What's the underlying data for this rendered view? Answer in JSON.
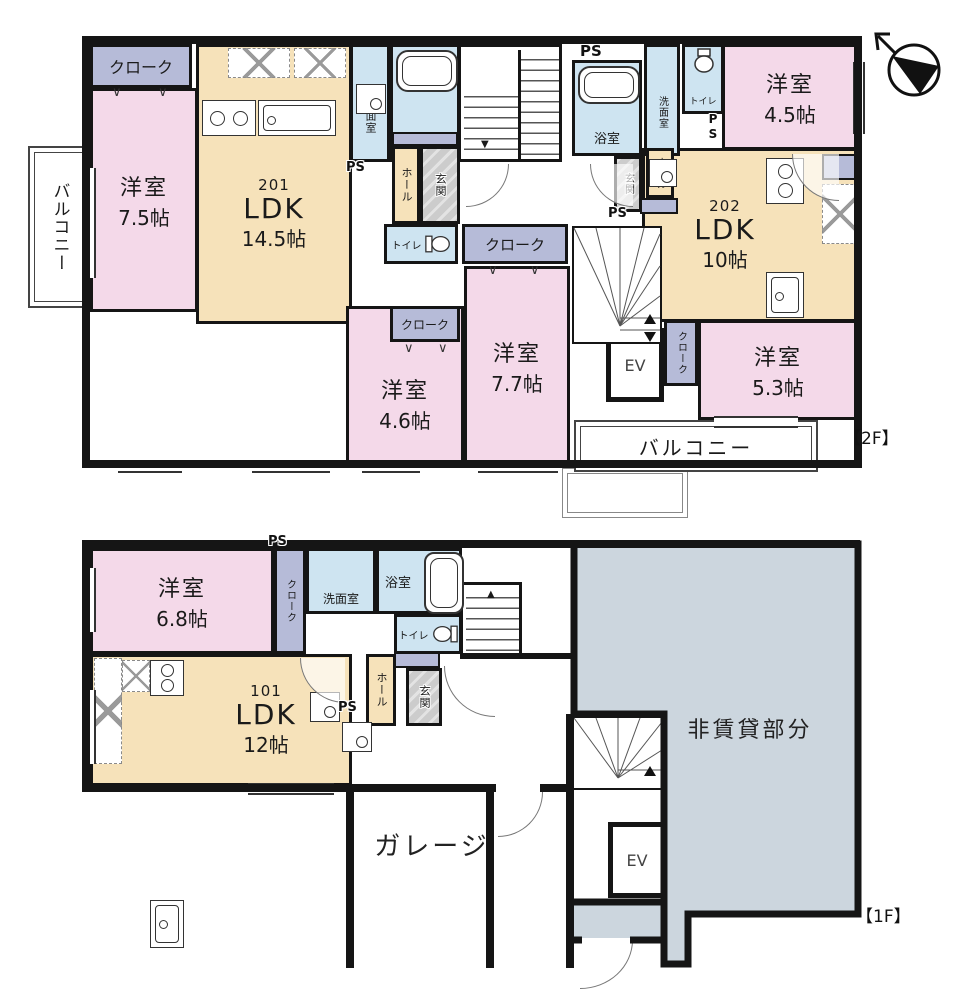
{
  "colors": {
    "room_pink": "#f4d9e9",
    "ldk_tan": "#f6e2ba",
    "closet_lavender": "#b6bbd8",
    "water_blue": "#cee4f1",
    "entrance_gray": "#cccccc",
    "non_rental_gray": "#ccd6de",
    "wall": "#151515"
  },
  "floor2": {
    "tag": "【2F】",
    "balcony_left": "バルコニー",
    "balcony_right": "バルコニー",
    "cloak_top_left": "クローク",
    "room_75": {
      "name": "洋室",
      "area": "7.5帖"
    },
    "unit201": {
      "number": "201",
      "type": "LDK",
      "area": "14.5帖"
    },
    "washroom_201": "洗面室",
    "bath_201": "浴室",
    "ps_201": "PS",
    "hall_201": "ホール",
    "entrance_201": "玄関",
    "toilet_201": "トイレ",
    "cloak_center": "クローク",
    "cloak_46": "クローク",
    "room_46": {
      "name": "洋室",
      "area": "4.6帖"
    },
    "room_77": {
      "name": "洋室",
      "area": "7.7帖"
    },
    "elevator": "EV",
    "cloak_202": "クローク",
    "room_53": {
      "name": "洋室",
      "area": "5.3帖"
    },
    "unit202": {
      "number": "202",
      "type": "LDK",
      "area": "10帖"
    },
    "room_45": {
      "name": "洋室",
      "area": "4.5帖"
    },
    "ps_top": "PS",
    "bath_202": "浴室",
    "washroom_202": "洗面室",
    "toilet_202": "トイレ",
    "ps_202_side": "PS",
    "entrance_202": "玄関",
    "hall_202": "ホール",
    "ps_202_bottom": "PS"
  },
  "floor1": {
    "tag": "【1F】",
    "room_68": {
      "name": "洋室",
      "area": "6.8帖"
    },
    "ps_closet": "PS",
    "cloak": "クローク",
    "washroom": "洗面室",
    "bath": "浴室",
    "toilet": "トイレ",
    "unit101": {
      "number": "101",
      "type": "LDK",
      "area": "12帖"
    },
    "hall": "ホール",
    "ps_hall": "PS",
    "entrance": "玄関",
    "garage": "ガレージ",
    "elevator": "EV",
    "non_rental": "非賃貸部分"
  }
}
